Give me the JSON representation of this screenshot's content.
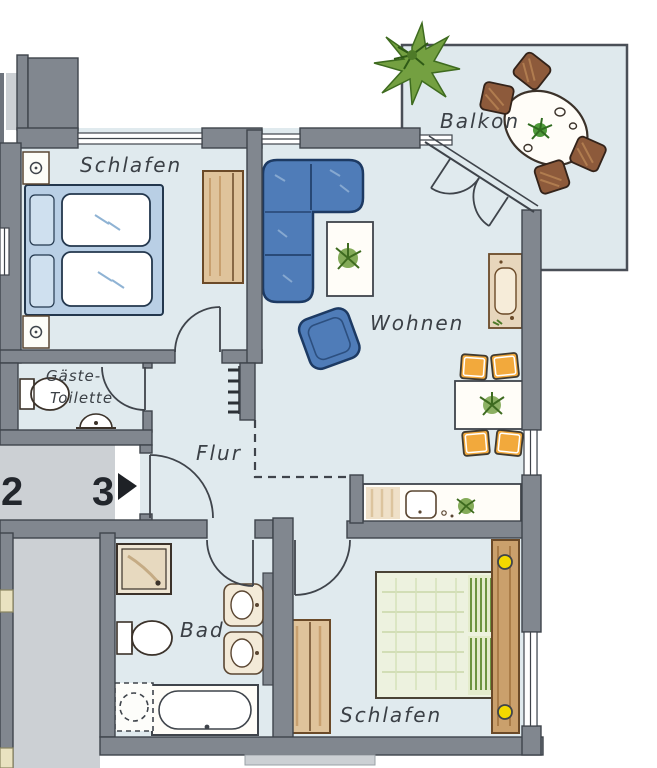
{
  "labels": {
    "bedroom_top": "Schlafen",
    "balcony": "Balkon",
    "living": "Wohnen",
    "guest_wc_line1": "Gäste-",
    "guest_wc_line2": "Toilette",
    "hall": "Flur",
    "bath": "Bad",
    "bedroom_bottom": "Schlafen",
    "unit_left": "2",
    "unit_current": "3"
  },
  "colors": {
    "wall": "#81878f",
    "wall_outline": "#3f444b",
    "floor": "#e0eaee",
    "landing_gray": "#ccd0d4",
    "sofa_blue": "#4f7cb8",
    "bed_blue": "#b9cfe5",
    "wood_tan": "#dfc39b",
    "chair_orange": "#f2a93c",
    "chair_brown": "#8d5a3b",
    "lamp_yellow": "#f3d900",
    "plant_green": "#5f9338",
    "bed_green": "#edf2df"
  },
  "rooms": [
    {
      "id": "bedroom-top",
      "label": "Schlafen",
      "furniture": [
        "double-bed",
        "nightstand",
        "nightstand",
        "wardrobe"
      ]
    },
    {
      "id": "guest-wc",
      "label": "Gäste-Toilette",
      "furniture": [
        "toilet",
        "washbasin"
      ]
    },
    {
      "id": "hall",
      "label": "Flur",
      "furniture": [
        "coat-rack"
      ]
    },
    {
      "id": "living",
      "label": "Wohnen",
      "furniture": [
        "corner-sofa",
        "armchair",
        "coffee-table-with-plant",
        "tv-board",
        "dining-table-with-plant",
        "dining-chairs",
        "sideboard-with-sink-and-plant"
      ]
    },
    {
      "id": "balcony",
      "label": "Balkon",
      "furniture": [
        "oval-table",
        "chairs",
        "potted-plant"
      ]
    },
    {
      "id": "bath",
      "label": "Bad",
      "furniture": [
        "shower",
        "toilet",
        "double-washbasin",
        "bathtub",
        "washing-machine"
      ]
    },
    {
      "id": "bedroom-bottom",
      "label": "Schlafen",
      "furniture": [
        "double-bed",
        "headboard-with-lamps",
        "wardrobe"
      ]
    }
  ],
  "landing": {
    "unit_left": "2",
    "unit_current": "3",
    "arrow": "entrance-arrow"
  }
}
